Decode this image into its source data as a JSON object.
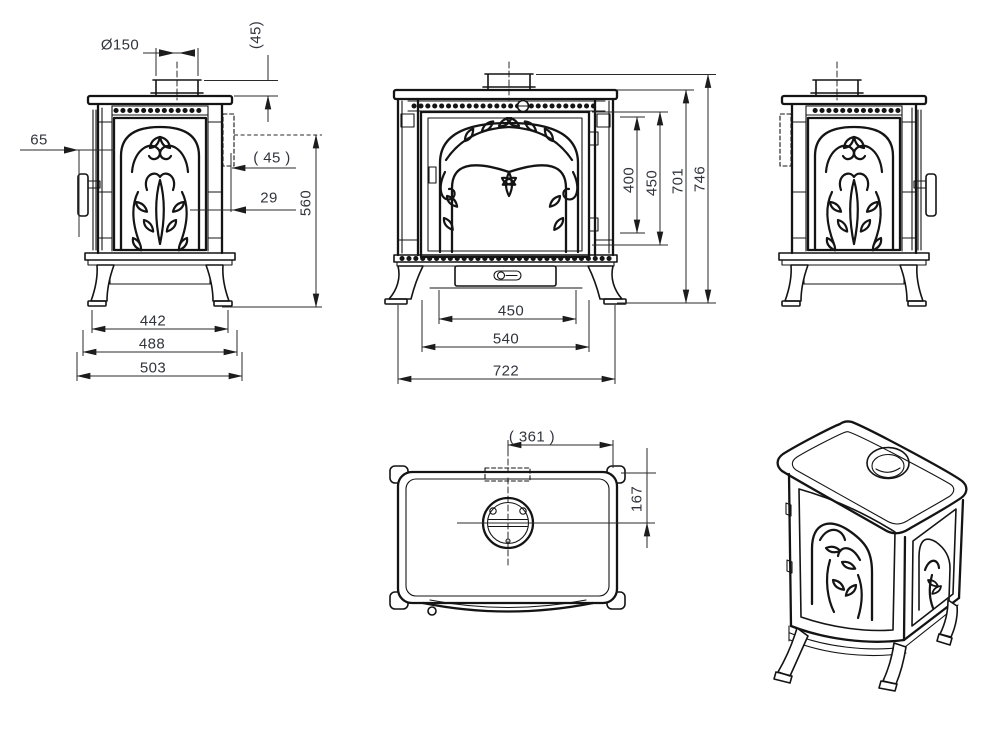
{
  "drawing": {
    "background_color": "#ffffff",
    "line_color": "#141414",
    "dimension_text_color": "#31343d",
    "views": {
      "side_left": {
        "dims": {
          "flue_diameter": "Ø150",
          "collar_height": "(45)",
          "handle_offset": "65",
          "rear_outlet_offset": "( 45 )",
          "rear_clearance": "29",
          "outlet_center_height": "560",
          "leg_span": "442",
          "base_depth": "488",
          "overall_depth": "503"
        }
      },
      "front": {
        "dims": {
          "glass_height": "400",
          "door_height": "450",
          "body_height": "701",
          "overall_height": "746",
          "drawer_width": "450",
          "door_width": "540",
          "overall_width": "722"
        }
      },
      "top": {
        "dims": {
          "flue_center_from_side": "( 361 )",
          "flue_center_from_rear": "167"
        }
      }
    }
  }
}
